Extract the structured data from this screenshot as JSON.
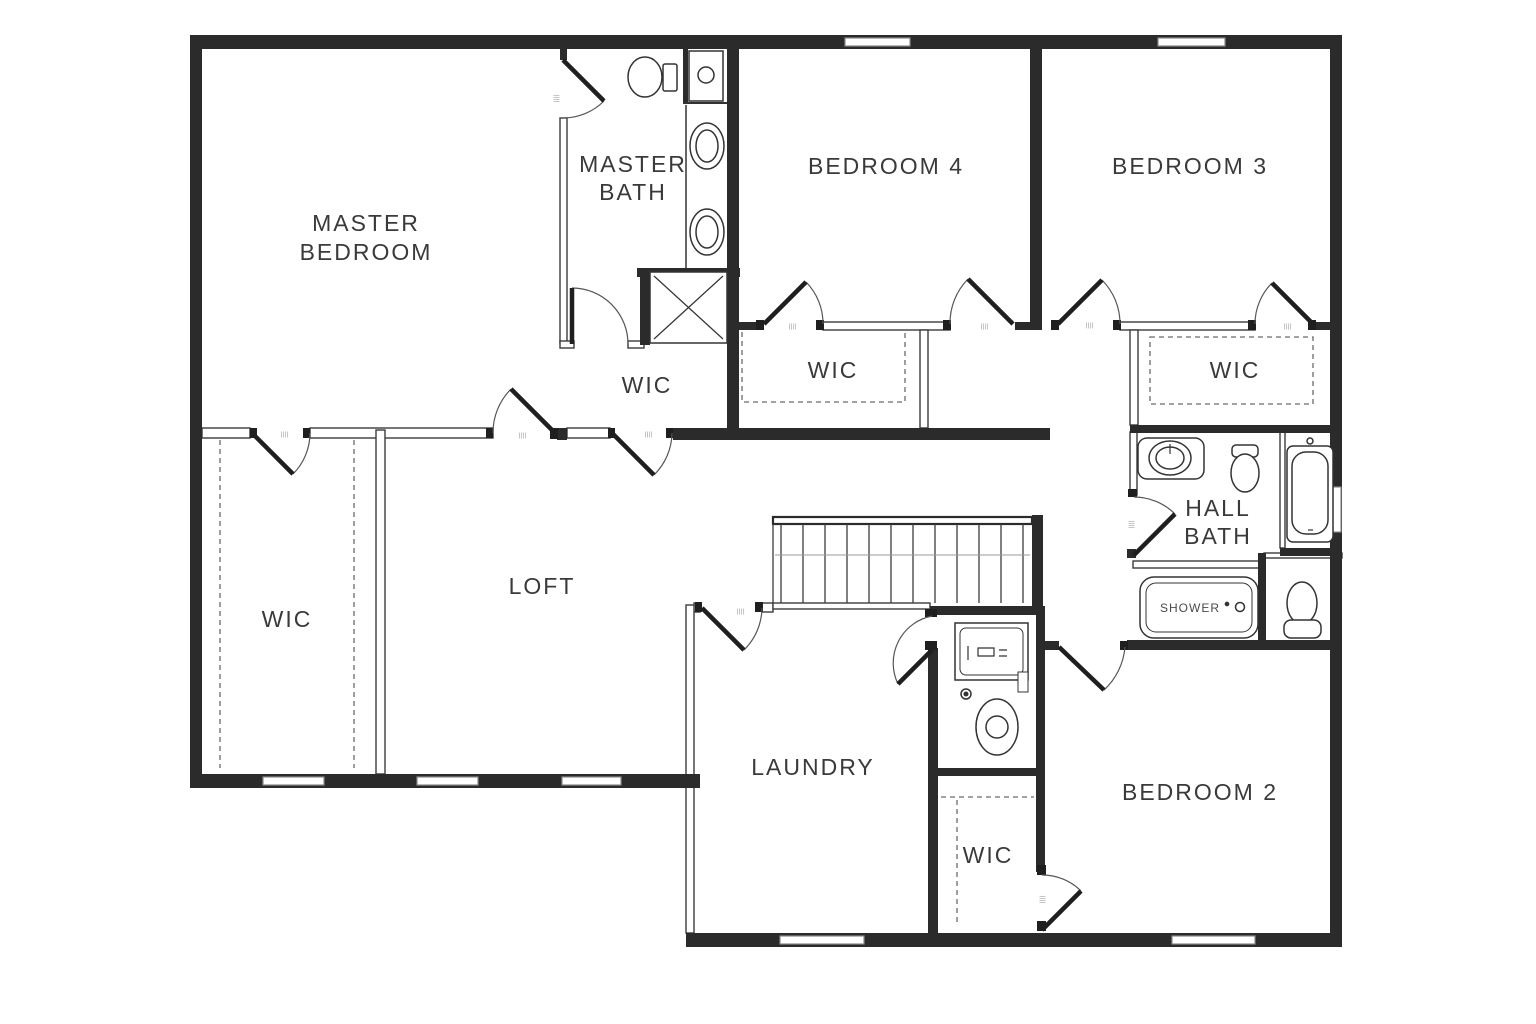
{
  "plan": {
    "title": "Second floor residential floor plan",
    "colors": {
      "background": "#ffffff",
      "wall": "#2b2b2b",
      "thin_line": "#3c3c3c",
      "arc_line": "#555555",
      "dash_line": "#6a6a6a",
      "window_line": "#8a8a8a",
      "text": "#3a3a3a"
    },
    "labels": {
      "master_bedroom_line1": "MASTER",
      "master_bedroom_line2": "BEDROOM",
      "master_bath_line1": "MASTER",
      "master_bath_line2": "BATH",
      "bedroom_4": "BEDROOM 4",
      "bedroom_3": "BEDROOM 3",
      "bedroom_2": "BEDROOM 2",
      "wic_left": "WIC",
      "wic_master": "WIC",
      "wic_bedroom_4": "WIC",
      "wic_bedroom_3": "WIC",
      "wic_bedroom_2": "WIC",
      "loft": "LOFT",
      "laundry": "LAUNDRY",
      "hall_bath_line1": "HALL",
      "hall_bath_line2": "BATH",
      "shower": "SHOWER",
      "door_tag": "||||"
    },
    "rooms": [
      "MASTER BEDROOM",
      "MASTER BATH",
      "BEDROOM 4",
      "BEDROOM 3",
      "BEDROOM 2",
      "LOFT",
      "LAUNDRY",
      "HALL BATH",
      "WIC x5"
    ],
    "fixtures": [
      "toilet x3",
      "vanity sink x3",
      "bathtub",
      "shower x2",
      "washer",
      "utility sink",
      "stairs"
    ]
  }
}
